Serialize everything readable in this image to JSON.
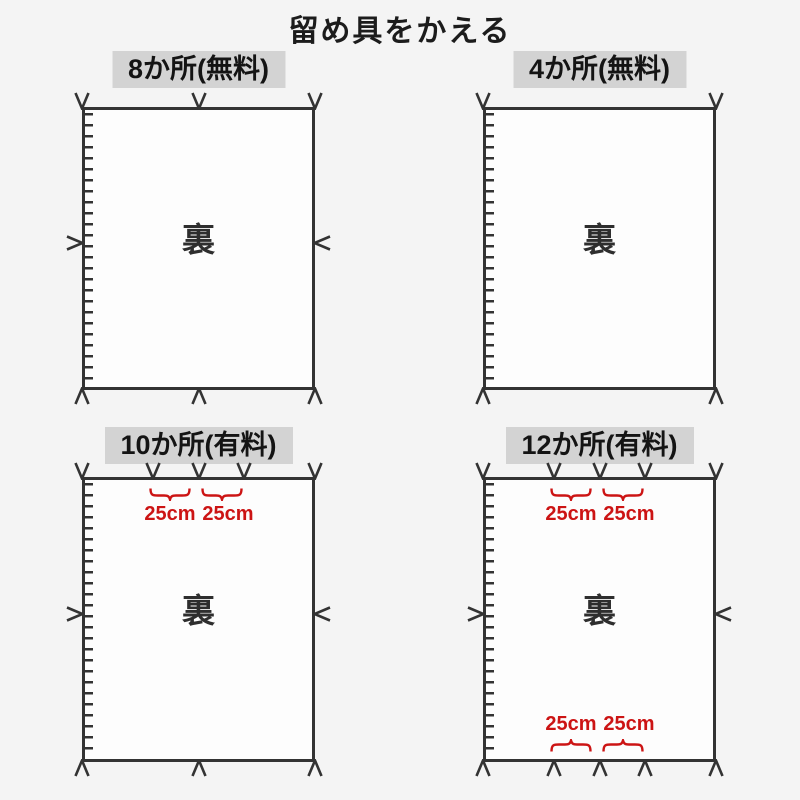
{
  "page": {
    "title": "留め具をかえる"
  },
  "colors": {
    "background": "#f4f4f4",
    "line": "#333333",
    "red": "#cc1414",
    "header_bg": "#d3d3d3",
    "sheet_fill": "#fdfdfd"
  },
  "panels": [
    {
      "label": "8か所(無料)",
      "back_label": "裏",
      "markers": {
        "top": 3,
        "bottom": 3,
        "left": 1,
        "right": 1
      }
    },
    {
      "label": "4か所(無料)",
      "back_label": "裏",
      "markers": {
        "top": 2,
        "bottom": 2,
        "left": 0,
        "right": 0
      }
    },
    {
      "label": "10か所(有料)",
      "back_label": "裏",
      "markers": {
        "top": 5,
        "bottom": 3,
        "left": 1,
        "right": 1
      },
      "top_spacing_labels": [
        "25cm",
        "25cm"
      ]
    },
    {
      "label": "12か所(有料)",
      "back_label": "裏",
      "markers": {
        "top": 5,
        "bottom": 5,
        "left": 1,
        "right": 1
      },
      "top_spacing_labels": [
        "25cm",
        "25cm"
      ],
      "bottom_spacing_labels": [
        "25cm",
        "25cm"
      ]
    }
  ]
}
